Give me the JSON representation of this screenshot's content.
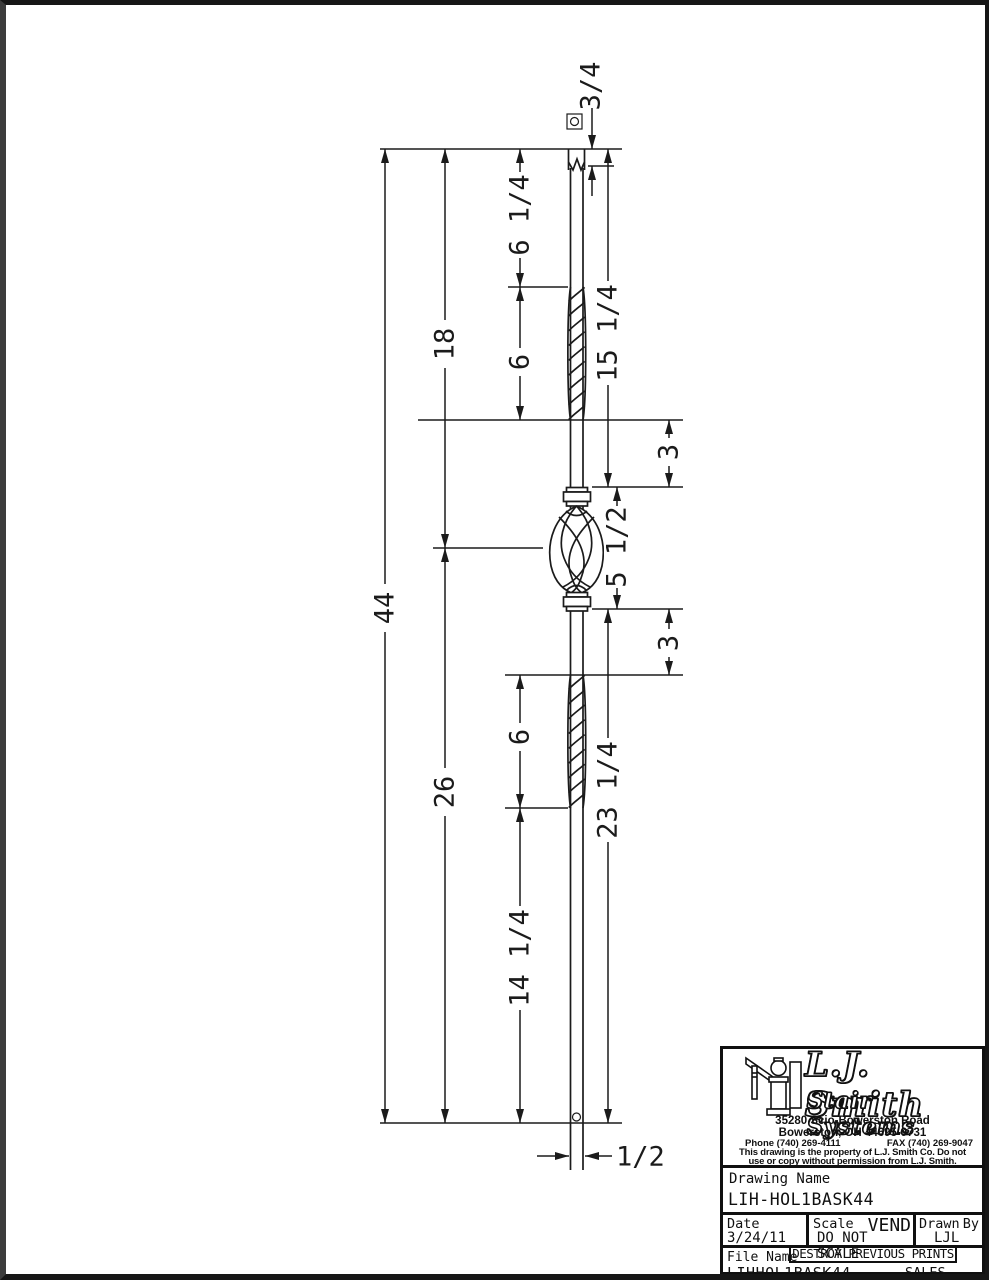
{
  "dims": {
    "square_top": "3/4",
    "seg_6_14": "6 1/4",
    "twist_upper": "6",
    "upper_18": "18",
    "upper_15_14": "15 1/4",
    "gap_upper_3": "3",
    "basket_5_12": "5 1/2",
    "overall_44": "44",
    "gap_lower_3": "3",
    "twist_lower": "6",
    "lower_26": "26",
    "lower_23_14": "23 1/4",
    "lower_14_14": "14 1/4",
    "width_1_2": "1/2"
  },
  "title_block": {
    "company_line1": "L.J. Smith",
    "company_line2": "Stair Systems",
    "address1": "35280 Scio-Bowerston Road",
    "address2": "Bowerston, OH 44695-9731",
    "phone": "Phone (740) 269-4111",
    "fax": "FAX (740) 269-9047",
    "notice1": "This drawing is the property of L.J. Smith Co. Do not",
    "notice2": "use or copy without permission from L.J. Smith.",
    "drawing_name_label": "Drawing Name",
    "drawing_name": "LIH-HOL1BASK44",
    "date_label": "Date",
    "date": "3/24/11",
    "scale_label": "Scale",
    "scale_tag": "VEND",
    "scale_value": "DO NOT SCALE",
    "drawn_by_label_1": "Drawn",
    "drawn_by_label_2": "By",
    "drawn_by": "LJL",
    "file_name_label": "File Name",
    "file_name": "LIHHOL1BASK44",
    "stamp": "DESTROY PREVIOUS PRINTS",
    "dept": "SALES"
  }
}
